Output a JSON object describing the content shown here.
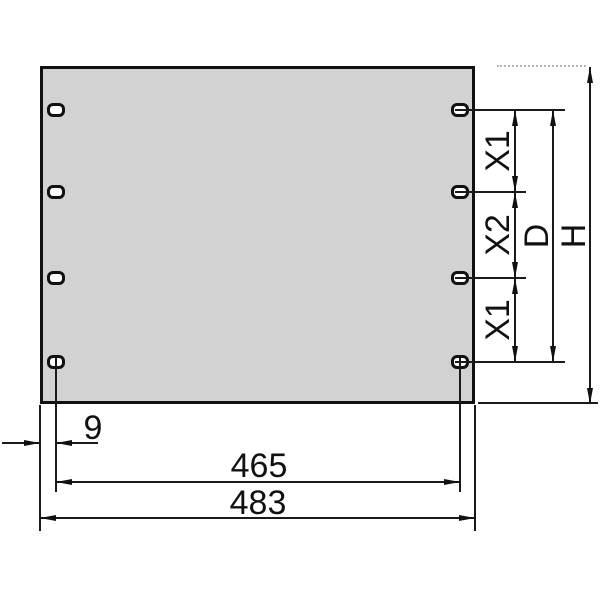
{
  "drawing": {
    "type": "technical-drawing",
    "subject": "rack-panel-front-view-with-mounting-slots",
    "colors": {
      "panel_fill": "#d2d2d2",
      "line": "#111111",
      "hidden_extension_line": "#b5b5b5"
    },
    "labels": {
      "edge_to_hole_offset": "9",
      "hole_span_width": "465",
      "total_width": "483",
      "x1_top": "X1",
      "x2_middle": "X2",
      "x1_bottom": "X1",
      "hole_span_height": "D",
      "total_height": "H"
    }
  }
}
